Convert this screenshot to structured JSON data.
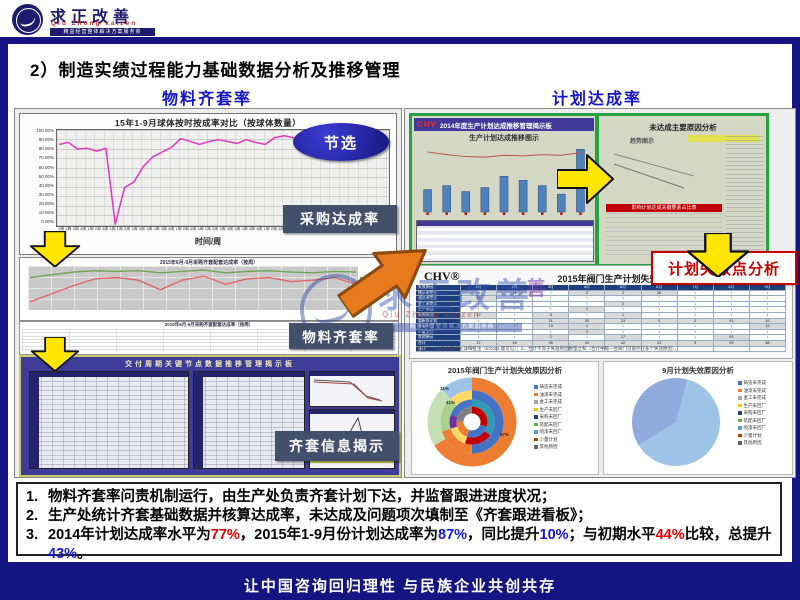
{
  "header": {
    "logo_title": "求正改善",
    "logo_subtitle": "Qiu Zhong kaizen",
    "logo_tagline": "精益经营整体解决方案服务商"
  },
  "page": {
    "title": "2）制造实绩过程能力基础数据分析及推移管理",
    "footer": "让中国咨询回归理性  与民族企业共创共存"
  },
  "columns": {
    "left_header": "物料齐套率",
    "right_header": "计划达成率"
  },
  "callouts": {
    "excerpt": "节选",
    "purchase_rate": "采购达成率",
    "material_rate": "物料齐套率",
    "kit_info": "齐套信息揭示",
    "plan_failure": "计划失效点分析"
  },
  "kit_board": {
    "title": "交付周期关键节点数据推移管理揭示板"
  },
  "dashboard": {
    "logo": "CHV",
    "title": "2014年度生产计划达成推移管理揭示板",
    "left_subtitle": "生产计划达成推移图示",
    "right_subtitle": "未达成主要原因分析",
    "trend_label": "趋势图示",
    "red_strip_label": "影响计划达成关键要素占比表"
  },
  "notes": {
    "marker1": "1.",
    "marker2": "2.",
    "marker3": "3.",
    "item1": "物料齐套率问责机制运行，由生产处负责齐套计划下达，并监督跟进进度状况；",
    "item2": "生产处统计齐套基础数据并核算达成率，未达成及问题项次填制至《齐套跟进看板》；",
    "item3": {
      "s1": "2014年计划达成率水平为",
      "v1": "77%",
      "s2": "，2015年1-9月份计划达成率为",
      "v2": "87%",
      "s3": "，同比提升",
      "v3": "10%",
      "s4": "；与初期水平",
      "v4": "44%",
      "s5": "比较，总提升",
      "v5": "43%",
      "s6": "。"
    }
  },
  "chart_data": [
    {
      "id": "ball-on-time-rate",
      "type": "line",
      "title": "15年1-9月球体按时按成率对比（按球体数量）",
      "xlabel": "时间/周",
      "ylim": [
        0,
        100
      ],
      "yticks": [
        "100.00%",
        "90.00%",
        "80.00%",
        "70.00%",
        "60.00%",
        "50.00%",
        "40.00%",
        "30.00%",
        "20.00%",
        "10.00%",
        "0.00%"
      ],
      "xticks": [
        "1周",
        "2周",
        "3周",
        "4周",
        "1周",
        "2周",
        "3周",
        "4周",
        "1周",
        "2周",
        "3周",
        "4周",
        "1周",
        "2周",
        "3周",
        "4周",
        "1周",
        "2周",
        "3周",
        "4周",
        "1周",
        "2周",
        "3周",
        "4周",
        "1周",
        "2周",
        "3周",
        "4周",
        "1周",
        "2周",
        "3周",
        "4周",
        "1周",
        "2周",
        "3周",
        "4周"
      ],
      "series": [
        {
          "name": "球体按时配套达成率",
          "color": "#e040c0",
          "width": 1.6,
          "values": [
            85,
            87,
            80,
            81,
            78,
            81,
            2,
            40,
            46,
            62,
            72,
            77,
            82,
            91,
            88,
            85,
            88,
            90,
            88,
            86,
            90,
            87,
            85,
            92,
            94,
            92,
            91,
            95,
            93,
            90,
            92,
            94,
            91,
            89,
            88,
            87
          ]
        }
      ]
    },
    {
      "id": "purchase-kit-rate",
      "type": "line",
      "title": "2015年6月-9月采购齐套配套达成率（按周）",
      "ylim": [
        40,
        105
      ],
      "series": [
        {
          "name": "齐套达成率",
          "color": "#6aa84f",
          "width": 1.4,
          "values": [
            88,
            92,
            96,
            98,
            97,
            98,
            95,
            97,
            99,
            95,
            97,
            98,
            96,
            95,
            97,
            96
          ]
        },
        {
          "name": "配套达成率",
          "color": "#e06666",
          "width": 1.4,
          "values": [
            52,
            64,
            76,
            86,
            88,
            84,
            70,
            84,
            90,
            78,
            86,
            88,
            82,
            84,
            88,
            78
          ]
        }
      ],
      "legend": [
        {
          "label": "齐套达成率",
          "color": "#6aa84f"
        },
        {
          "label": "配套达成率",
          "color": "#e06666"
        }
      ]
    },
    {
      "id": "plan-achievement-bars",
      "type": "bar",
      "ymax": 100,
      "bar_color": "#4f81bd",
      "values": [
        34,
        40,
        31,
        37,
        54,
        48,
        40,
        27,
        95
      ],
      "line": [
        91,
        87,
        84,
        83,
        86,
        85,
        87,
        86,
        90
      ],
      "line_color": "#c0504d",
      "base_markers": true
    },
    {
      "id": "failure-reasons-table",
      "type": "table",
      "logo": "CHV®",
      "title": "2015年阀门生产计划失效原因分析",
      "col_header": "失效原因",
      "months": [
        "1月",
        "2月",
        "3月",
        "4月",
        "5月",
        "6月",
        "7月",
        "8月",
        "9月"
      ],
      "rows": [
        "铸造未完成",
        "油漆未完成",
        "金工未完成",
        "生产未回厂",
        "采购未回厂",
        "重新排计划",
        "装配未回厂",
        "少量交付",
        "其他原因"
      ],
      "cells": [
        [
          "9",
          "21",
          "\\",
          "2",
          "2",
          "26",
          "\\",
          "\\",
          "\\"
        ],
        [
          "13",
          "\\",
          "\\",
          "\\",
          "\\",
          "\\",
          "\\",
          "\\",
          "\\"
        ],
        [
          "\\",
          "\\",
          "\\",
          "\\",
          "2",
          "\\",
          "\\",
          "\\",
          "\\"
        ],
        [
          "\\",
          "\\",
          "\\",
          "1",
          "\\",
          "\\",
          "\\",
          "\\",
          "\\"
        ],
        [
          "12",
          "\\",
          "8",
          "\\",
          "1",
          "\\",
          "\\",
          "\\",
          "\\"
        ],
        [
          "\\",
          "\\",
          "21",
          "30",
          "23",
          "3",
          "2",
          "93",
          "19"
        ],
        [
          "\\",
          "\\",
          "19",
          "2",
          "\\",
          "\\",
          "\\",
          "\\",
          "19"
        ],
        [
          "\\",
          "\\",
          "\\",
          "2",
          "\\",
          "\\",
          "\\",
          "\\",
          "\\"
        ],
        [
          "\\",
          "\\",
          "2",
          "\\",
          "17",
          "\\",
          "\\",
          "93",
          "\\"
        ]
      ],
      "total_label": "合计",
      "totals": [
        "27",
        "45",
        "46",
        "34",
        "42",
        "22",
        "3",
        "93",
        "48"
      ],
      "note_label": "备注",
      "footnote": "备注：1、失效数量录入详细批注（EXCEL版可见）；2、合计不等于失效原因数量之和（合计中每一台阀门可能存在多个失效原因）。",
      "stamp": "善"
    },
    {
      "id": "failure-reasons-2015-sunburst",
      "type": "rings",
      "title": "2015年阀门生产计划失效原因分析",
      "labels": [
        "11%",
        "41%",
        "57%"
      ],
      "rings": [
        {
          "r": 38,
          "w": 13,
          "segments": [
            {
              "color": "#ed7d31",
              "frac": 0.66
            },
            {
              "color": "#c5e0b4",
              "frac": 0.22
            },
            {
              "color": "#9dc3e6",
              "frac": 0.12
            }
          ]
        },
        {
          "r": 27,
          "w": 9,
          "segments": [
            {
              "color": "#4472c4",
              "frac": 0.5
            },
            {
              "color": "#ed7d31",
              "frac": 0.2
            },
            {
              "color": "#a9d18e",
              "frac": 0.18
            },
            {
              "color": "#ffd966",
              "frac": 0.12
            }
          ]
        },
        {
          "r": 19,
          "w": 7,
          "segments": [
            {
              "color": "#2e9bb5",
              "frac": 0.35
            },
            {
              "color": "#c00000",
              "frac": 0.2
            },
            {
              "color": "#ffd966",
              "frac": 0.15
            },
            {
              "color": "#7030a0",
              "frac": 0.1
            },
            {
              "color": "#4472c4",
              "frac": 0.2
            }
          ]
        },
        {
          "r": 12,
          "w": 7,
          "segments": [
            {
              "color": "#c00000",
              "frac": 0.3
            },
            {
              "color": "#4472c4",
              "frac": 0.25
            },
            {
              "color": "#ed7d31",
              "frac": 0.2
            },
            {
              "color": "#808080",
              "frac": 0.25
            }
          ]
        },
        {
          "r": 4,
          "w": 8,
          "segments": [
            {
              "color": "#ffffff",
              "frac": 1
            }
          ]
        }
      ],
      "legend": [
        {
          "label": "铸造未完成",
          "color": "#4472c4"
        },
        {
          "label": "油漆未完成",
          "color": "#ed7d31"
        },
        {
          "label": "金工未完成",
          "color": "#a5a5a5"
        },
        {
          "label": "生产未回厂",
          "color": "#ffc000"
        },
        {
          "label": "采购未回厂",
          "color": "#264478"
        },
        {
          "label": "装配未回厂",
          "color": "#70ad47"
        },
        {
          "label": "喷漆未回厂",
          "color": "#5b9bd5"
        },
        {
          "label": "少量计划",
          "color": "#9e480e"
        },
        {
          "label": "其他原因",
          "color": "#636363"
        }
      ]
    },
    {
      "id": "failure-reasons-sep-pie",
      "type": "pie",
      "title": "9月计划失效原因分析",
      "values": [
        62,
        38
      ],
      "colors": [
        "#9dc3e6",
        "#8faadc"
      ],
      "start_deg": 15,
      "legend": [
        {
          "label": "铸造未完成",
          "color": "#4472c4"
        },
        {
          "label": "油漆未完成",
          "color": "#ed7d31"
        },
        {
          "label": "金工未完成",
          "color": "#a5a5a5"
        },
        {
          "label": "生产未回厂",
          "color": "#ffc000"
        },
        {
          "label": "采购未回厂",
          "color": "#264478"
        },
        {
          "label": "装配未回厂",
          "color": "#70ad47"
        },
        {
          "label": "喷漆未回厂",
          "color": "#5b9bd5"
        },
        {
          "label": "少量计划",
          "color": "#9e480e"
        },
        {
          "label": "其他原因",
          "color": "#636363"
        }
      ]
    }
  ]
}
